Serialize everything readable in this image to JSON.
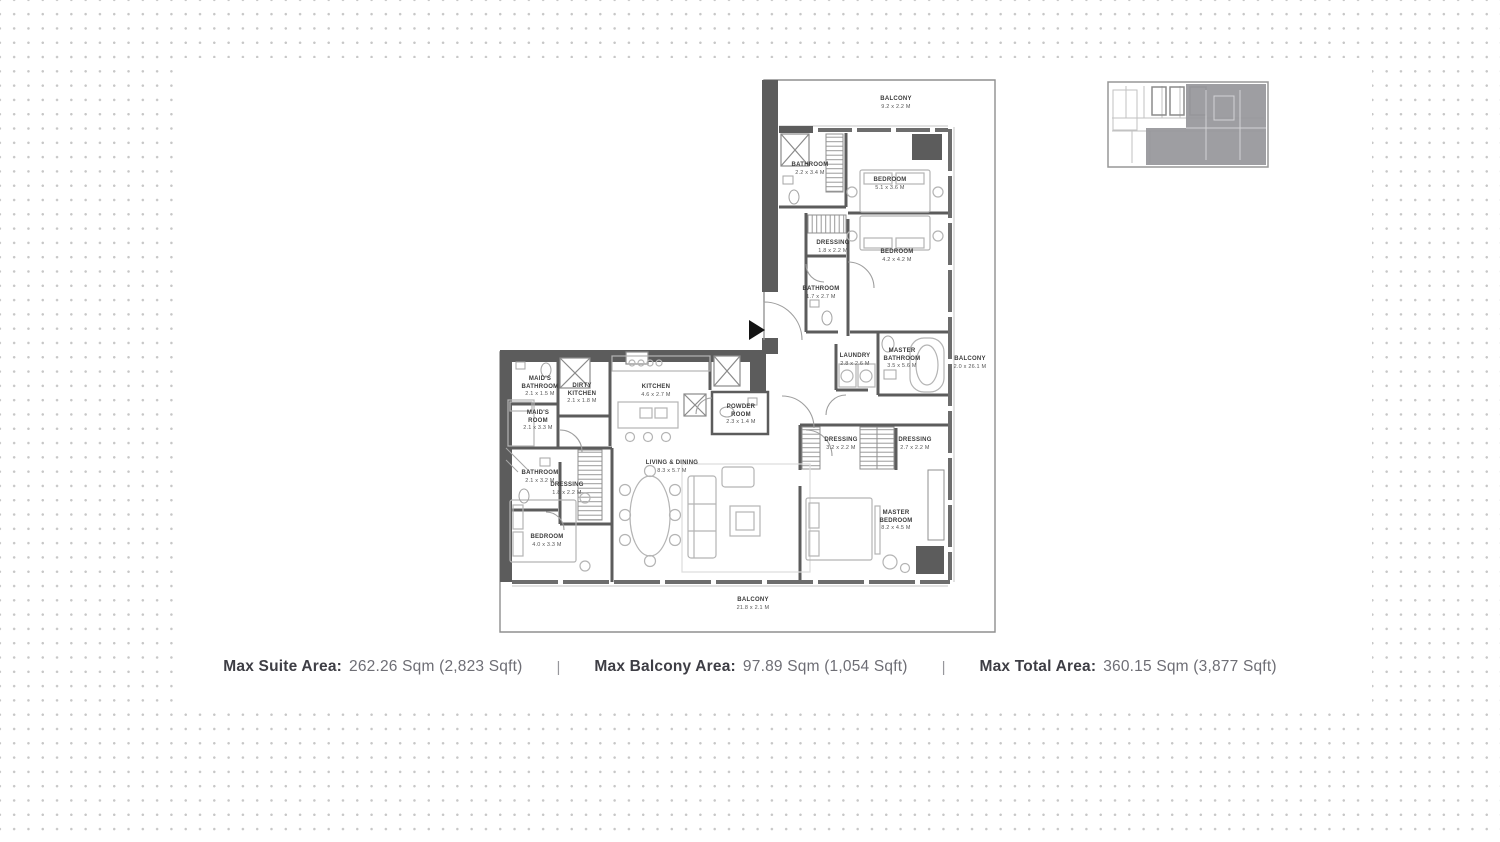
{
  "colors": {
    "wall": "#5c5c5c",
    "thin_line": "#b4b4b4",
    "dot_grid": "#c7c7c7",
    "key_plan_highlight": "#96969a",
    "stats_label": "#3e3e45",
    "stats_value": "#6e6e75"
  },
  "stats": {
    "separator": "|",
    "suite": {
      "label": "Max Suite Area:",
      "value": "262.26 Sqm (2,823 Sqft)"
    },
    "balcony": {
      "label": "Max Balcony Area:",
      "value": "97.89 Sqm (1,054 Sqft)"
    },
    "total": {
      "label": "Max Total Area:",
      "value": "360.15 Sqm (3,877 Sqft)"
    }
  },
  "plan": {
    "rooms": [
      {
        "name": "BALCONY",
        "dims": "9.2 x 2.2 M"
      },
      {
        "name": "BATHROOM",
        "dims": "2.2 x 3.4 M"
      },
      {
        "name": "BEDROOM",
        "dims": "5.1 x 3.6 M"
      },
      {
        "name": "DRESSING",
        "dims": "1.8 x 2.2 M"
      },
      {
        "name": "BEDROOM",
        "dims": "4.2 x 4.2 M"
      },
      {
        "name": "BATHROOM",
        "dims": "1.7 x 2.7 M"
      },
      {
        "name": "LAUNDRY",
        "dims": "2.8 x 2.6 M"
      },
      {
        "name": "MASTER BATHROOM",
        "dims": "3.5 x 5.6 M"
      },
      {
        "name": "BALCONY",
        "dims": "2.0 x 26.1 M"
      },
      {
        "name": "MAID'S BATHROOM",
        "dims": "2.1 x 1.5 M"
      },
      {
        "name": "DIRTY KITCHEN",
        "dims": "2.1 x 1.8 M"
      },
      {
        "name": "KITCHEN",
        "dims": "4.6 x 2.7 M"
      },
      {
        "name": "MAID'S ROOM",
        "dims": "2.1 x 3.3 M"
      },
      {
        "name": "POWDER ROOM",
        "dims": "2.3 x 1.4 M"
      },
      {
        "name": "BATHROOM",
        "dims": "2.1 x 3.2 M"
      },
      {
        "name": "DRESSING",
        "dims": "1.8 x 2.2 M"
      },
      {
        "name": "LIVING & DINING",
        "dims": "8.3 x 5.7 M"
      },
      {
        "name": "DRESSING",
        "dims": "3.2 x 2.2 M"
      },
      {
        "name": "DRESSING",
        "dims": "2.7 x 2.2 M"
      },
      {
        "name": "BEDROOM",
        "dims": "4.0 x 3.3 M"
      },
      {
        "name": "MASTER BEDROOM",
        "dims": "8.2 x 4.5 M"
      },
      {
        "name": "BALCONY",
        "dims": "21.8 x 2.1 M"
      }
    ]
  }
}
